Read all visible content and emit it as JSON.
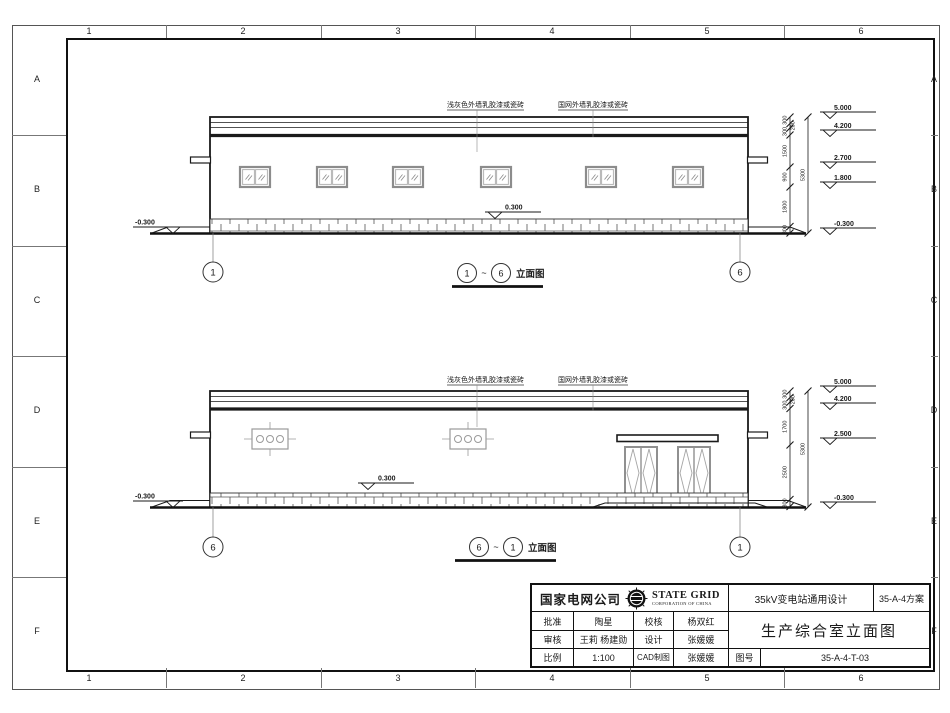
{
  "sheet": {
    "zone_columns": [
      "1",
      "2",
      "3",
      "4",
      "5",
      "6"
    ],
    "zone_rows": [
      "A",
      "B",
      "C",
      "D",
      "E",
      "F"
    ]
  },
  "top_elevation": {
    "finish_note_left": "浅灰色外墙乳胶漆或瓷砖",
    "finish_note_right": "国网外墙乳胶漆或瓷砖",
    "level_top": "5.000",
    "level_roof": "4.200",
    "level_win_top": "2.700",
    "level_win_sill": "1.800",
    "level_ground_right": "-0.300",
    "level_ground_left": "-0.300",
    "level_plinth": "0.300",
    "dims": [
      "300",
      "200",
      "300",
      "1500",
      "900",
      "1800",
      "300"
    ],
    "dim_total": "5300",
    "grid_left": "1",
    "grid_right": "6",
    "caption": {
      "bubble_left": "1",
      "separator": "~",
      "bubble_right": "6",
      "label": "立面图"
    }
  },
  "bottom_elevation": {
    "finish_note_left": "浅灰色外墙乳胶漆或瓷砖",
    "finish_note_right": "国网外墙乳胶漆或瓷砖",
    "level_top": "5.000",
    "level_roof": "4.200",
    "level_canopy": "2.500",
    "level_ground_right": "-0.300",
    "level_ground_left": "-0.300",
    "level_plinth": "0.300",
    "dims": [
      "300",
      "200",
      "300",
      "1700",
      "2500",
      "300"
    ],
    "dim_total": "5300",
    "grid_left": "6",
    "grid_right": "1",
    "caption": {
      "bubble_left": "6",
      "separator": "~",
      "bubble_right": "1",
      "label": "立面图"
    }
  },
  "title_block": {
    "company": "国家电网公司",
    "brand_line1": "STATE GRID",
    "brand_line2": "CORPORATION OF CHINA",
    "project": "35kV变电站通用设计",
    "scheme": "35-A-4方案",
    "approve_label": "批准",
    "approve_name": "陶星",
    "check_label": "校核",
    "check_name": "杨双红",
    "review_label": "审核",
    "review_name": "王莉 杨建勋",
    "design_label": "设计",
    "design_name": "张媛媛",
    "scale_label": "比例",
    "scale_value": "1:100",
    "cad_label": "CAD制图",
    "cad_name": "张媛媛",
    "drawing_title": "生产综合室立面图",
    "number_label": "图号",
    "drawing_number": "35-A-4-T-03"
  }
}
